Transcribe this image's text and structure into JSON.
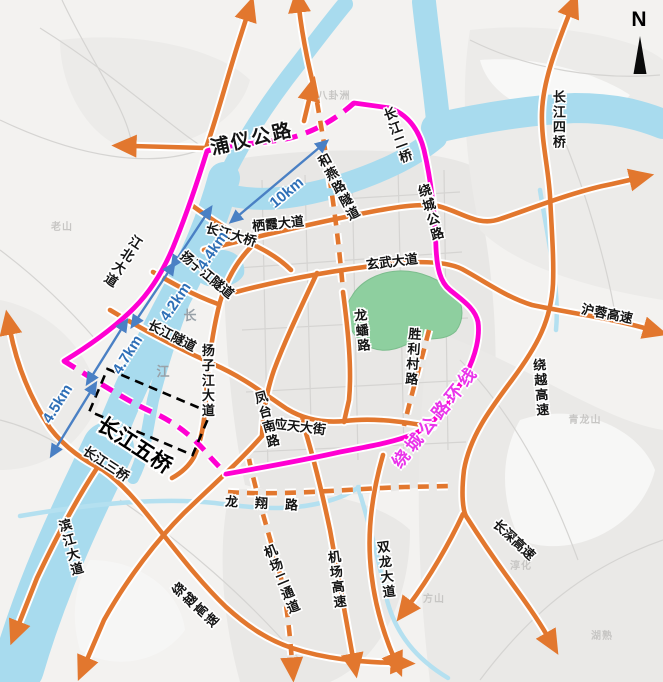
{
  "map_title": "南京过江通道及绕城公路环线示意图",
  "colors": {
    "road_orange": "#e2772e",
    "ring_magenta": "#ff00d2",
    "ring_text_magenta": "#e935ea",
    "river_blue": "#a8dbee",
    "stream_blue": "#b4e0f0",
    "green_area": "#8ecf9f",
    "km_blue": "#2e6fb7",
    "label_black": "#141414"
  },
  "compass": {
    "letter": "N"
  },
  "labels": [
    {
      "id": "label-puyi-road",
      "text": "浦仪公路",
      "x": 252,
      "y": 140,
      "rot": -13,
      "cls": "road xl"
    },
    {
      "id": "label-changjiang-2-bridge",
      "text": "长江二桥",
      "x": 397,
      "y": 136,
      "rot": -20,
      "cls": "road v"
    },
    {
      "id": "label-raocheng-road",
      "text": "绕城公路",
      "x": 430,
      "y": 213,
      "rot": -16,
      "cls": "road v"
    },
    {
      "id": "label-changjiang-4-bridge",
      "text": "长江四桥",
      "x": 558,
      "y": 120,
      "rot": 0,
      "cls": "road v"
    },
    {
      "id": "label-heyan-road-tunnel",
      "text": "和燕路隧道",
      "x": 338,
      "y": 188,
      "rot": -28,
      "cls": "road v"
    },
    {
      "id": "label-qixia-avenue",
      "text": "栖霞大道",
      "x": 278,
      "y": 224,
      "rot": -6,
      "cls": "road"
    },
    {
      "id": "label-xuanwu-avenue",
      "text": "玄武大道",
      "x": 392,
      "y": 262,
      "rot": -7,
      "cls": "road"
    },
    {
      "id": "label-hurong-expressway",
      "text": "沪蓉高速",
      "x": 607,
      "y": 314,
      "rot": 11,
      "cls": "road"
    },
    {
      "id": "label-raoyue-expwy-east",
      "text": "绕越高速",
      "x": 540,
      "y": 388,
      "rot": -4,
      "cls": "road v"
    },
    {
      "id": "label-changshen-expressway",
      "text": "长深高速",
      "x": 514,
      "y": 540,
      "rot": 43,
      "cls": "road"
    },
    {
      "id": "label-changjiang-bridge",
      "text": "长江大桥",
      "x": 231,
      "y": 235,
      "rot": 16,
      "cls": "road"
    },
    {
      "id": "label-yangzijiang-tunnel",
      "text": "扬子江隧道",
      "x": 207,
      "y": 275,
      "rot": 40,
      "cls": "road"
    },
    {
      "id": "label-changjiang-tunnel",
      "text": "长江隧道",
      "x": 172,
      "y": 336,
      "rot": 27,
      "cls": "road"
    },
    {
      "id": "label-yangzijiang-avenue",
      "text": "扬子江大道",
      "x": 207,
      "y": 381,
      "rot": 0,
      "cls": "road v"
    },
    {
      "id": "label-jiangbei-avenue",
      "text": "江北大道",
      "x": 122,
      "y": 261,
      "rot": 33,
      "cls": "road v"
    },
    {
      "id": "label-yingtian-street",
      "text": "应天大街",
      "x": 300,
      "y": 427,
      "rot": 7,
      "cls": "road"
    },
    {
      "id": "label-fengtai-south-road",
      "text": "凤台南路",
      "x": 266,
      "y": 420,
      "rot": -15,
      "cls": "road v"
    },
    {
      "id": "label-longpan-road",
      "text": "龙蟠路",
      "x": 361,
      "y": 331,
      "rot": -6,
      "cls": "road v"
    },
    {
      "id": "label-shenglicun-road",
      "text": "胜利村路",
      "x": 412,
      "y": 357,
      "rot": 4,
      "cls": "road v"
    },
    {
      "id": "label-longxiang-road",
      "text": "龙翔路",
      "x": 270,
      "y": 504,
      "rot": 3,
      "cls": "road sp"
    },
    {
      "id": "label-airport-2nd-corridor",
      "text": "机场二通道",
      "x": 281,
      "y": 580,
      "rot": -22,
      "cls": "road v"
    },
    {
      "id": "label-airport-expressway",
      "text": "机场高速",
      "x": 336,
      "y": 580,
      "rot": -7,
      "cls": "road v"
    },
    {
      "id": "label-shuanglong-avenue",
      "text": "双龙大道",
      "x": 385,
      "y": 570,
      "rot": -7,
      "cls": "road v"
    },
    {
      "id": "label-binjiang-avenue",
      "text": "滨江大道",
      "x": 70,
      "y": 548,
      "rot": -15,
      "cls": "road v"
    },
    {
      "id": "label-raoyue-expwy-west",
      "text": "绕越高速",
      "x": 195,
      "y": 606,
      "rot": -47,
      "cls": "road v"
    },
    {
      "id": "label-changjiang-3-bridge",
      "text": "长江三桥",
      "x": 106,
      "y": 464,
      "rot": 33,
      "cls": "road"
    },
    {
      "id": "label-changjiang-5-bridge",
      "text": "长江五桥",
      "x": 134,
      "y": 446,
      "rot": 33,
      "cls": "big"
    },
    {
      "id": "label-ring-expressway-loop",
      "text": "绕城公路环线",
      "x": 436,
      "y": 417,
      "rot": -51,
      "cls": "ring"
    },
    {
      "id": "label-dist-10km",
      "text": "10km",
      "x": 287,
      "y": 193,
      "rot": -40,
      "cls": "km"
    },
    {
      "id": "label-dist-4-4km",
      "text": "4.4km",
      "x": 213,
      "y": 251,
      "rot": -56,
      "cls": "km"
    },
    {
      "id": "label-dist-4-2km",
      "text": "4.2km",
      "x": 176,
      "y": 302,
      "rot": -56,
      "cls": "km"
    },
    {
      "id": "label-dist-4-7km",
      "text": "4.7km",
      "x": 128,
      "y": 355,
      "rot": -58,
      "cls": "km"
    },
    {
      "id": "label-dist-4-5km",
      "text": "4.5km",
      "x": 58,
      "y": 404,
      "rot": -58,
      "cls": "km"
    },
    {
      "id": "label-north",
      "text": "N",
      "x": 639,
      "y": 20,
      "rot": 0,
      "cls": "north"
    },
    {
      "id": "label-river-char-chang",
      "text": "长",
      "x": 190,
      "y": 316,
      "rot": 0,
      "cls": "rlab"
    },
    {
      "id": "label-river-char-jiang",
      "text": "江",
      "x": 163,
      "y": 372,
      "rot": 0,
      "cls": "rlab"
    },
    {
      "id": "label-terrain-baguazhou",
      "text": "八卦洲",
      "x": 334,
      "y": 97,
      "rot": 0,
      "cls": "faint"
    },
    {
      "id": "label-terrain-laoshan",
      "text": "老山",
      "x": 62,
      "y": 228,
      "rot": 0,
      "cls": "faint"
    },
    {
      "id": "label-terrain-qinglongshan",
      "text": "青龙山",
      "x": 585,
      "y": 421,
      "rot": 0,
      "cls": "faint"
    },
    {
      "id": "label-terrain-fangshan",
      "text": "方山",
      "x": 434,
      "y": 600,
      "rot": 0,
      "cls": "faint"
    },
    {
      "id": "label-terrain-hushu",
      "text": "湖熟",
      "x": 602,
      "y": 637,
      "rot": 0,
      "cls": "faint"
    },
    {
      "id": "label-terrain-chunhua",
      "text": "淳化",
      "x": 521,
      "y": 567,
      "rot": 0,
      "cls": "faint"
    }
  ]
}
